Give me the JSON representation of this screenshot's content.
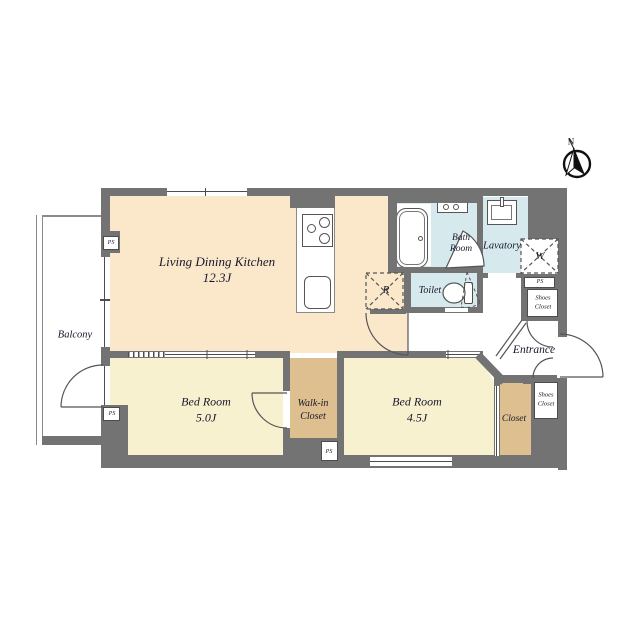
{
  "compass": {
    "north_label": "N"
  },
  "rooms": {
    "ldk": {
      "name": "Living Dining Kitchen",
      "size": "12.3J"
    },
    "bedroom_left": {
      "name": "Bed Room",
      "size": "5.0J"
    },
    "bedroom_right": {
      "name": "Bed Room",
      "size": "4.5J"
    },
    "walk_in_closet": {
      "name_line1": "Walk-in",
      "name_line2": "Closet"
    },
    "closet": {
      "name": "Closet"
    },
    "balcony": {
      "name": "Balcony"
    },
    "bath_room": {
      "name_line1": "Bath",
      "name_line2": "Room"
    },
    "lavatory": {
      "name": "Lavatory"
    },
    "toilet": {
      "name": "Toilet"
    },
    "entrance": {
      "name": "Entrance"
    },
    "shoes_closet_upper": {
      "name_line1": "Shoes",
      "name_line2": "Closet"
    },
    "shoes_closet_lower": {
      "name_line1": "Shoes",
      "name_line2": "Closet"
    }
  },
  "fixtures": {
    "refrigerator_label": "R",
    "washer_label": "W",
    "pipe_space_labels": {
      "top_left": "PS",
      "mid_left": "PS",
      "walk_in": "PS",
      "right": "PS"
    }
  },
  "colors": {
    "wall": "#737373",
    "ldk_floor": "#fbe8cb",
    "bedroom_floor": "#f8f1d0",
    "closet_floor": "#debf90",
    "wet_area_floor": "#d6eaee",
    "line": "#4c4c4c",
    "text": "#17172a"
  }
}
